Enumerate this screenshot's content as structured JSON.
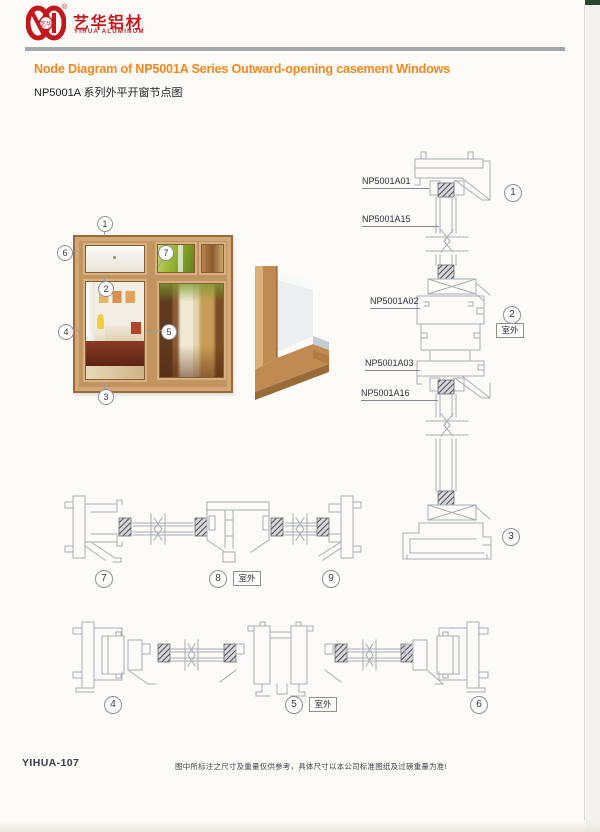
{
  "brand": {
    "name_cn": "艺华铝材",
    "name_en": "YIHUA ALUMINUM",
    "registered_mark": "®",
    "logo_color": "#c2181d"
  },
  "header": {
    "title_en": "Node Diagram of NP5001A Series Outward-opening casement Windows",
    "title_cn": "NP5001A 系列外平开窗节点图",
    "accent_color": "#f6871f"
  },
  "window_illustration": {
    "callouts": {
      "c1": "1",
      "c2": "2",
      "c3": "3",
      "c4": "4",
      "c5": "5",
      "c6": "6",
      "c7": "7"
    }
  },
  "vertical_section": {
    "labels": {
      "a01": "NP5001A01",
      "a15": "NP5001A15",
      "a02": "NP5001A02",
      "a03": "NP5001A03",
      "a16": "NP5001A16"
    },
    "callouts": {
      "c1": "1",
      "c2": "2",
      "c3": "3"
    },
    "outdoor_label": "室外"
  },
  "middle_section": {
    "callouts": {
      "c7": "7",
      "c8": "8",
      "c9": "9"
    },
    "outdoor_label": "室外"
  },
  "bottom_section": {
    "callouts": {
      "c4": "4",
      "c5": "5",
      "c6": "6"
    },
    "outdoor_label": "室外"
  },
  "footer": {
    "page_code": "YIHUA-107",
    "disclaimer": "图中所标注之尺寸及重量仅供参考，具体尺寸以本公司标准图纸及过磅重量为准!"
  }
}
